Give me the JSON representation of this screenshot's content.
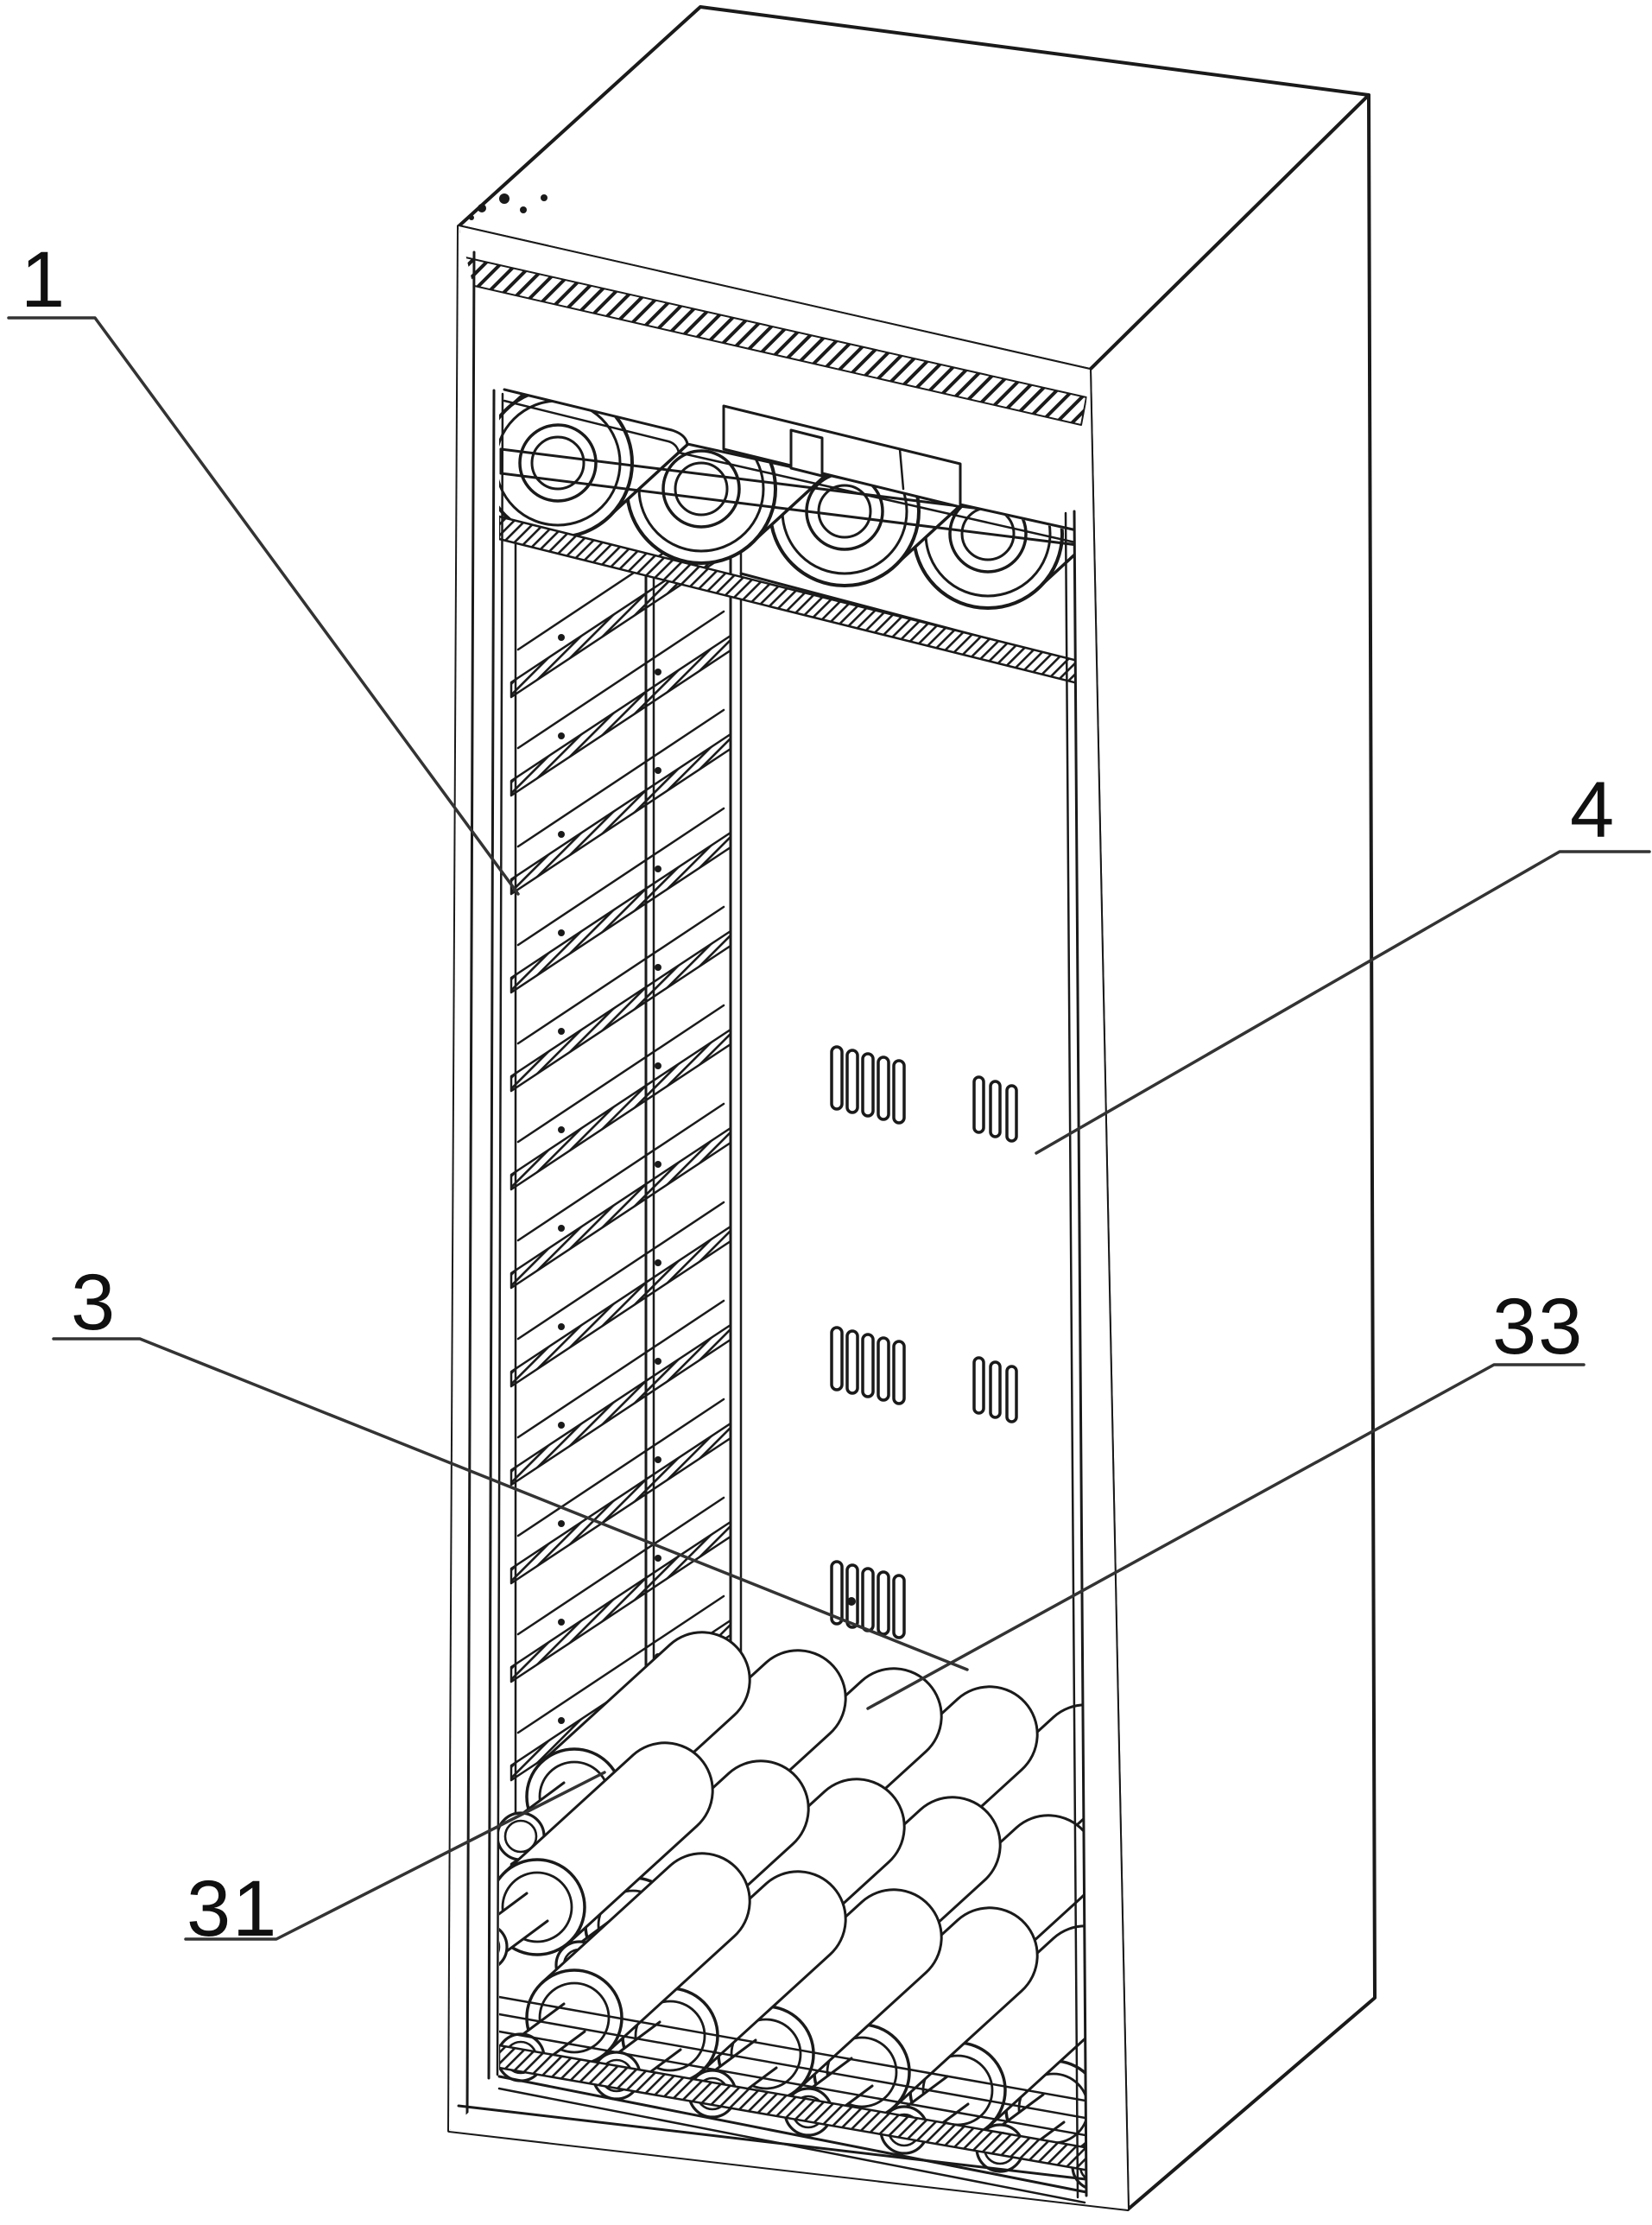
{
  "figure": {
    "background": "#ffffff",
    "line_color": "#1a1a1a",
    "leader_color": "#333333",
    "labels": [
      {
        "ref": "1"
      },
      {
        "ref": "4"
      },
      {
        "ref": "3"
      },
      {
        "ref": "33"
      },
      {
        "ref": "31"
      }
    ],
    "scene": {
      "subject": "Perspective line drawing of a tall bottle storage cabinet",
      "top_shelf_bottle_count": 4,
      "left_rack_rail_count": 13,
      "bottom_bottle_rows": 3,
      "vent_slot_groups": [
        {
          "row": 1,
          "slots": 5
        },
        {
          "row": 1,
          "slots": 3
        },
        {
          "row": 2,
          "slots": 5
        },
        {
          "row": 2,
          "slots": 3
        },
        {
          "row": 3,
          "slots": 5
        }
      ]
    }
  }
}
